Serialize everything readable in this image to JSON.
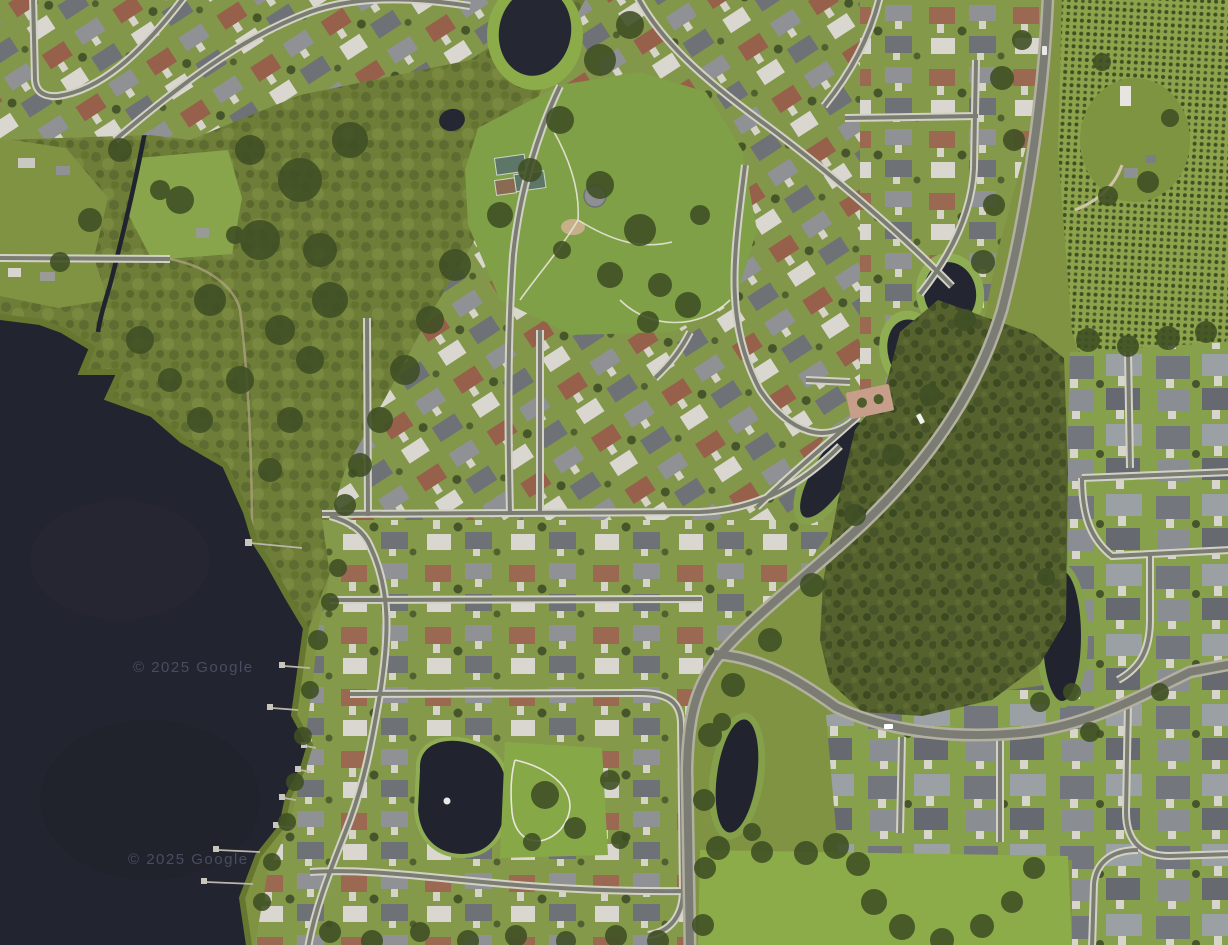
{
  "map": {
    "description": "Aerial satellite view of lakeside suburban neighborhoods with a park, ponds, forest tract and orchard",
    "attribution": {
      "text": "© 2025 Google"
    },
    "colors": {
      "water": "#22242f",
      "grass": "#7f9343",
      "grass_bright": "#8cab49",
      "marsh": "#6e7d38",
      "forest": "#55622e",
      "tree": "#3f4f24",
      "street_asphalt": "#7b7c72",
      "sidewalk": "#d2d1c6",
      "main_road": "#7b7d74",
      "road_shoulder": "#b3b0a0",
      "pond_fringe": "#8fae54",
      "court_green": "#5d7668",
      "court_red": "#8a6b52",
      "plaza_brick": "#c79e8a",
      "dock": "#c9c7bc",
      "watermark": "#4f556a"
    }
  }
}
